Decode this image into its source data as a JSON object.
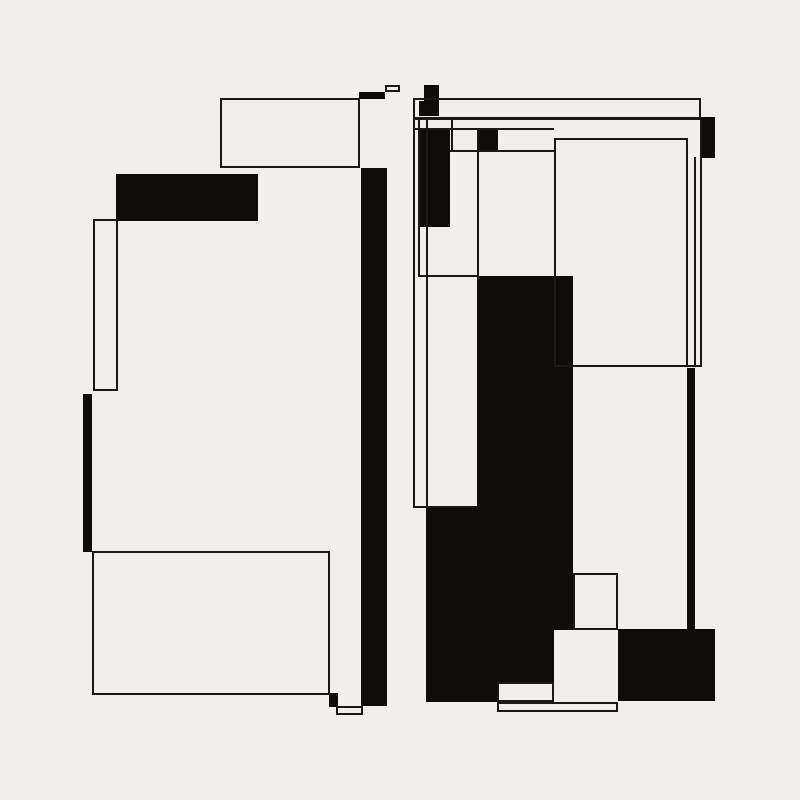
{
  "artwork": {
    "title": "abstract-rectangular-composition",
    "background_color": "#f0efeb",
    "ink_color": "#0e0d0b",
    "line_color": "#1a1916",
    "canvas": {
      "width": 800,
      "height": 800
    },
    "shapes": [
      {
        "name": "left-black-header-rect",
        "kind": "black",
        "x": 116,
        "y": 174,
        "w": 142,
        "h": 47
      },
      {
        "name": "left-top-black-bar",
        "kind": "black",
        "x": 359,
        "y": 92,
        "w": 26,
        "h": 7
      },
      {
        "name": "left-main-vertical-bar",
        "kind": "black",
        "x": 361,
        "y": 168,
        "w": 26,
        "h": 538
      },
      {
        "name": "left-thick-edge-bar",
        "kind": "black",
        "x": 83,
        "y": 394,
        "w": 9,
        "h": 158
      },
      {
        "name": "left-bottom-corner-square",
        "kind": "black",
        "x": 329,
        "y": 693,
        "w": 9,
        "h": 14
      },
      {
        "name": "right-top-small-square",
        "kind": "black",
        "x": 424,
        "y": 85,
        "w": 15,
        "h": 16
      },
      {
        "name": "right-upper-small-square",
        "kind": "black",
        "x": 419,
        "y": 101,
        "w": 20,
        "h": 15
      },
      {
        "name": "right-tall-black-rect",
        "kind": "black",
        "x": 419,
        "y": 129,
        "w": 31,
        "h": 98
      },
      {
        "name": "right-cell-black-rect",
        "kind": "black",
        "x": 477,
        "y": 129,
        "w": 21,
        "h": 22
      },
      {
        "name": "right-edge-black-rect",
        "kind": "black",
        "x": 700,
        "y": 117,
        "w": 15,
        "h": 41
      },
      {
        "name": "center-black-mass-upper",
        "kind": "black",
        "x": 477,
        "y": 276,
        "w": 96,
        "h": 232
      },
      {
        "name": "center-black-mass-middle",
        "kind": "black",
        "x": 426,
        "y": 508,
        "w": 147,
        "h": 122
      },
      {
        "name": "center-black-mass-lower",
        "kind": "black",
        "x": 426,
        "y": 630,
        "w": 128,
        "h": 72
      },
      {
        "name": "right-thick-vertical-bar",
        "kind": "black",
        "x": 687,
        "y": 368,
        "w": 8,
        "h": 262
      },
      {
        "name": "bottom-right-black-rect",
        "kind": "black",
        "x": 618,
        "y": 629,
        "w": 97,
        "h": 72
      },
      {
        "name": "left-top-outline-rect",
        "kind": "outline",
        "x": 220,
        "y": 98,
        "w": 140,
        "h": 70
      },
      {
        "name": "left-tiny-outline-rect",
        "kind": "outline",
        "x": 385,
        "y": 85,
        "w": 15,
        "h": 7
      },
      {
        "name": "left-narrow-outline-rect",
        "kind": "outline",
        "x": 93,
        "y": 219,
        "w": 25,
        "h": 172
      },
      {
        "name": "left-bottom-outline-rect",
        "kind": "outline",
        "x": 92,
        "y": 551,
        "w": 238,
        "h": 144
      },
      {
        "name": "left-bottom-small-outline",
        "kind": "outline",
        "x": 336,
        "y": 706,
        "w": 27,
        "h": 9
      },
      {
        "name": "right-top-band-outline",
        "kind": "outline",
        "x": 413,
        "y": 98,
        "w": 288,
        "h": 22
      },
      {
        "name": "right-large-outline-rect",
        "kind": "outline",
        "x": 554,
        "y": 138,
        "w": 134,
        "h": 229
      },
      {
        "name": "band-inner-line",
        "kind": "hline",
        "x": 413,
        "y": 117,
        "w": 288,
        "h": 2
      },
      {
        "name": "upper-grid-line-a",
        "kind": "hline",
        "x": 413,
        "y": 128,
        "w": 141,
        "h": 2
      },
      {
        "name": "upper-grid-line-b",
        "kind": "hline",
        "x": 450,
        "y": 150,
        "w": 104,
        "h": 2
      },
      {
        "name": "mid-connector-line",
        "kind": "hline",
        "x": 418,
        "y": 275,
        "w": 61,
        "h": 2
      },
      {
        "name": "lower-connector-line",
        "kind": "hline",
        "x": 413,
        "y": 506,
        "w": 65,
        "h": 2
      },
      {
        "name": "outline-bottom-extension",
        "kind": "hline",
        "x": 688,
        "y": 365,
        "w": 14,
        "h": 2
      },
      {
        "name": "left-vertical-line-1",
        "kind": "vline",
        "x": 413,
        "y": 118,
        "w": 2,
        "h": 390
      },
      {
        "name": "left-vertical-line-2",
        "kind": "vline",
        "x": 418,
        "y": 118,
        "w": 2,
        "h": 158
      },
      {
        "name": "left-vertical-line-3",
        "kind": "vline",
        "x": 426,
        "y": 118,
        "w": 2,
        "h": 390
      },
      {
        "name": "cell-vertical-line",
        "kind": "vline",
        "x": 451,
        "y": 118,
        "w": 2,
        "h": 34
      },
      {
        "name": "mass-corner-vertical-line",
        "kind": "vline",
        "x": 477,
        "y": 128,
        "w": 2,
        "h": 148
      },
      {
        "name": "right-vertical-line-inner",
        "kind": "vline",
        "x": 694,
        "y": 157,
        "w": 2,
        "h": 210
      },
      {
        "name": "right-vertical-line-outer",
        "kind": "vline",
        "x": 700,
        "y": 118,
        "w": 2,
        "h": 249
      },
      {
        "name": "embedded-white-square",
        "kind": "white",
        "x": 573,
        "y": 573,
        "w": 45,
        "h": 57
      },
      {
        "name": "bottom-notch-white-rect",
        "kind": "white",
        "x": 497,
        "y": 682,
        "w": 57,
        "h": 20
      },
      {
        "name": "bottom-white-strip",
        "kind": "white",
        "x": 497,
        "y": 702,
        "w": 121,
        "h": 10
      }
    ]
  }
}
